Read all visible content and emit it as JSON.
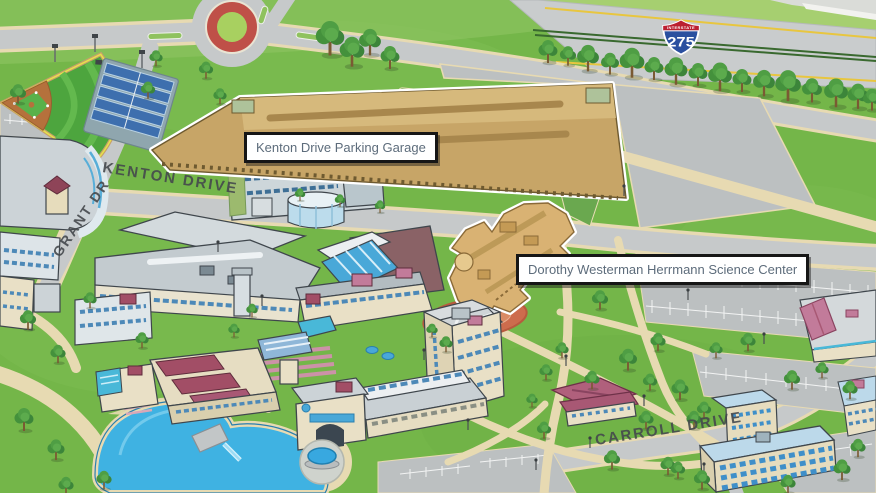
{
  "map": {
    "callouts": [
      {
        "label": "Kenton Drive Parking Garage"
      },
      {
        "label": "Dorothy Westerman Herrmann Science Center"
      }
    ],
    "streets": {
      "kenton_drive": "KENTON DRIVE",
      "grant_drive": "GRANT DR",
      "carroll_drive": "CARROLL DRIVE"
    },
    "interstate_shield": {
      "banner": "INTERSTATE",
      "number": "275"
    },
    "features": [
      "interstate-275-highway",
      "tree-line",
      "roundabout",
      "baseball-field",
      "tennis-courts",
      "parking-garage-highlighted",
      "science-center-highlighted",
      "campus-buildings",
      "library",
      "student-union",
      "residence-hall",
      "lake-with-bridge",
      "fountain-plaza",
      "parking-lots",
      "lawns-and-paths"
    ],
    "colors": {
      "grass": "#74b649",
      "road": "#c6c9ca",
      "parking_lot": "#bcc0c1",
      "path_tan": "#e7dab2",
      "water": "#3fb2e2",
      "highlight_building": "#c7a567",
      "highlight_outline": "#ffffff",
      "callout_text": "#5d6c7b",
      "callout_border": "#161616",
      "street_text": "#45494d",
      "shield_blue": "#2a4f9f",
      "shield_red": "#bb2030"
    }
  }
}
